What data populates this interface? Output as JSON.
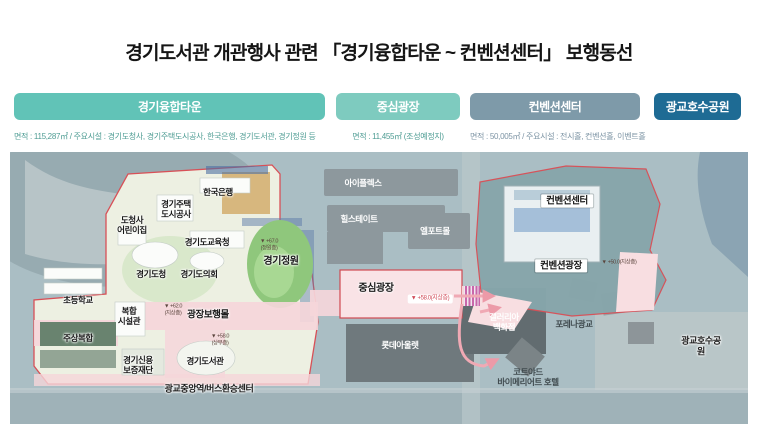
{
  "title": "경기도서관 개관행사 관련 「경기융합타운 ~ 컨벤션센터」 보행동선",
  "legend": {
    "zones": [
      {
        "label": "경기융합타운",
        "info": "면적 : 115,287㎡ / 주요시설 : 경기도청사, 경기주택도시공사, 한국은행, 경기도서관, 경기정원 등",
        "color": "#61c3b7"
      },
      {
        "label": "중심광장",
        "info": "면적 : 11,455㎡ (조성예정지)",
        "color": "#7ecbbf"
      },
      {
        "label": "컨벤션센터",
        "info": "면적 : 50,005㎡ / 주요시설 : 전시홀, 컨벤션홀, 이벤트홀",
        "color": "#7e9aa9"
      },
      {
        "label": "광교호수공원",
        "info": "",
        "color": "#1e6b94"
      }
    ]
  },
  "map": {
    "labels": {
      "bank": "한국은행",
      "ghcorp": "경기주택\n도시공사",
      "daycare": "도청사\n어린이집",
      "education": "경기도교육청",
      "provhall": "경기도청",
      "assembly": "경기도의회",
      "garden": "경기정원",
      "school": "초등학교",
      "complex": "복합\n시설관",
      "mall": "광장보행몰",
      "residential": "주상복합",
      "credit": "경기신용\n보증재단",
      "library": "경기도서관",
      "station": "광교중앙역/버스환승센터",
      "iplex": "아이플렉스",
      "hillstate": "힐스테이트",
      "elport": "엘포트몰",
      "plaza": "중심광장",
      "lotte": "롯데아울렛",
      "convention": "컨벤션센터",
      "convplaza": "컨벤션광장",
      "galleria": "갤러리아\n백화점",
      "forena": "포레나광교",
      "hotel": "코트야드\n바이메리어트 호텔",
      "lakepark": "광교호수공원"
    },
    "notes": {
      "garden_level": "▼ +67.0\n(정원층)",
      "mall_level": "▼ +62.0\n(지상층)",
      "library_level": "▼ +58.0\n(상부층)",
      "plaza_level": "▼ +58.0(지상층)",
      "convplaza_level": "▼ +50.0(지상층)"
    },
    "route_color": "#f0a9b4",
    "boundary_color": "#d85057"
  }
}
